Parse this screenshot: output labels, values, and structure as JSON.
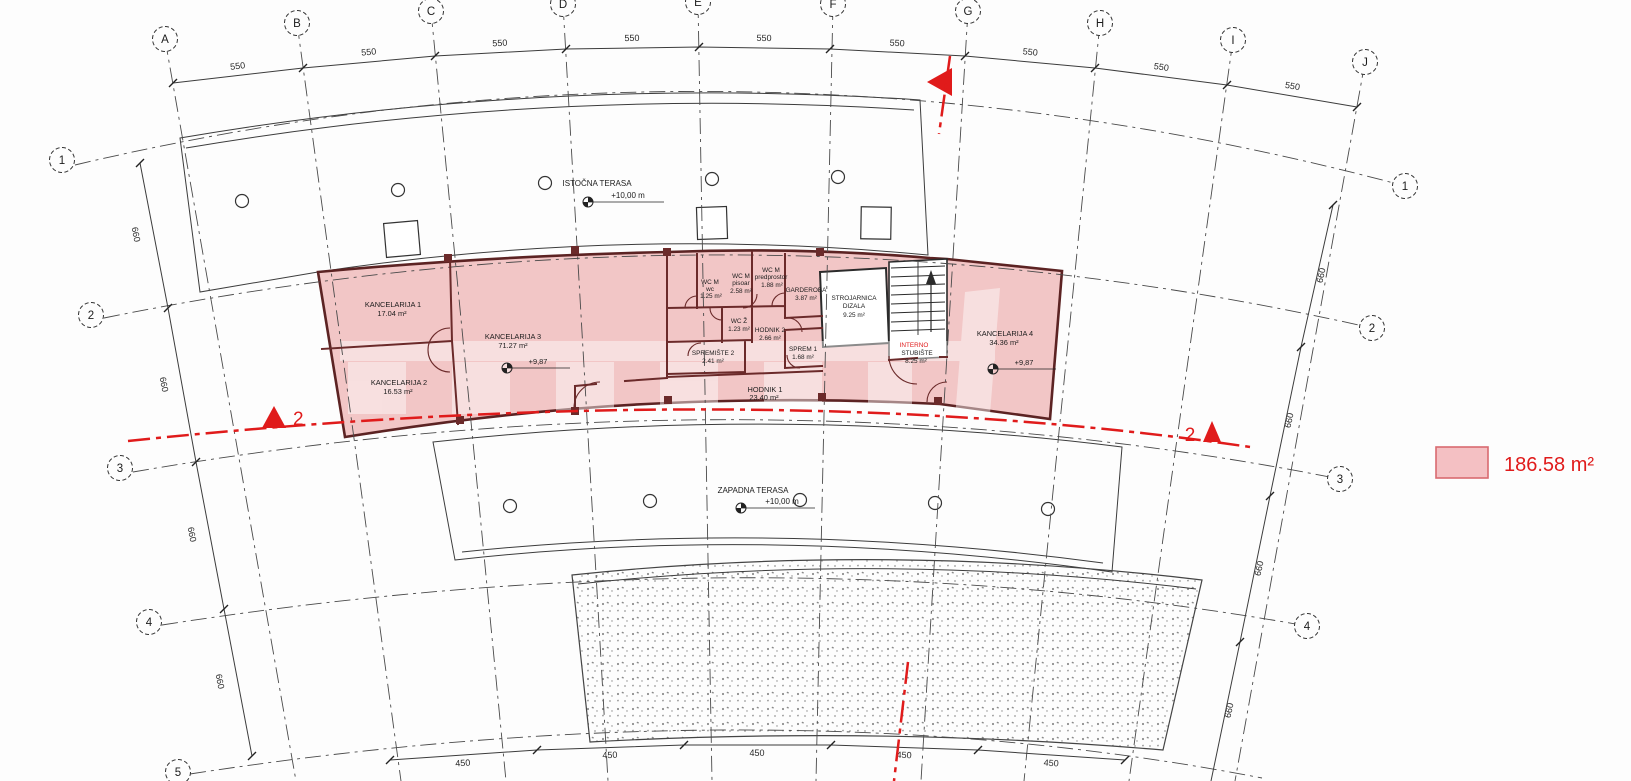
{
  "grid": {
    "top_letters": [
      "A",
      "B",
      "C",
      "D",
      "E",
      "F",
      "G",
      "H",
      "I",
      "J"
    ],
    "left_numbers": [
      "1",
      "2",
      "3",
      "4",
      "5"
    ],
    "right_numbers": [
      "1",
      "2",
      "3",
      "4"
    ],
    "dim_top": "550",
    "dim_side": "660",
    "dim_bottom": "450"
  },
  "terraces": {
    "east": {
      "name": "ISTOČNA TERASA",
      "level": "+10,00 m"
    },
    "west": {
      "name": "ZAPADNA TERASA",
      "level": "+10,00 m"
    }
  },
  "rooms": {
    "kancelarija1": {
      "name": "KANCELARIJA 1",
      "area": "17.04 m²"
    },
    "kancelarija2": {
      "name": "KANCELARIJA 2",
      "area": "16.53 m²"
    },
    "kancelarija3": {
      "name": "KANCELARIJA 3",
      "area": "71.27 m²",
      "level": "+9,87"
    },
    "kancelarija4": {
      "name": "KANCELARIJA 4",
      "area": "34.36 m²",
      "level": "+9,87"
    },
    "wc_m_wc": {
      "name": "WC M",
      "sub": "wc",
      "area": "1.25 m²"
    },
    "wc_m_pisoar": {
      "name": "WC M",
      "sub": "pisoar",
      "area": "2.58 m²"
    },
    "wc_m_predprostor": {
      "name": "WC M",
      "sub": "predprostor",
      "area": "1.88 m²"
    },
    "garderoba": {
      "name": "GARDEROBA",
      "area": "3.87 m²"
    },
    "wc_z": {
      "name": "WC Ž",
      "area": "1.23 m²"
    },
    "hodnik2": {
      "name": "HODNIK 2",
      "area": "2.66 m²"
    },
    "sprem1": {
      "name": "SPREM 1",
      "area": "1.68 m²"
    },
    "spremiste2": {
      "name": "SPREMIŠTE 2",
      "area": "2.41 m²"
    },
    "hodnik1": {
      "name": "HODNIK 1",
      "area": "23.40 m²"
    },
    "strojarnica": {
      "name": "STROJARNICA",
      "name2": "DIZALA",
      "area": "9.25 m²"
    },
    "stubiste": {
      "name": "INTERNO",
      "name2": "STUBIŠTE",
      "area": "8.25 m²"
    }
  },
  "section": {
    "label": "2"
  },
  "legend": {
    "area": "186.58 m²"
  },
  "colors": {
    "highlight": "#f2c6c6",
    "red": "#e01b1b"
  }
}
